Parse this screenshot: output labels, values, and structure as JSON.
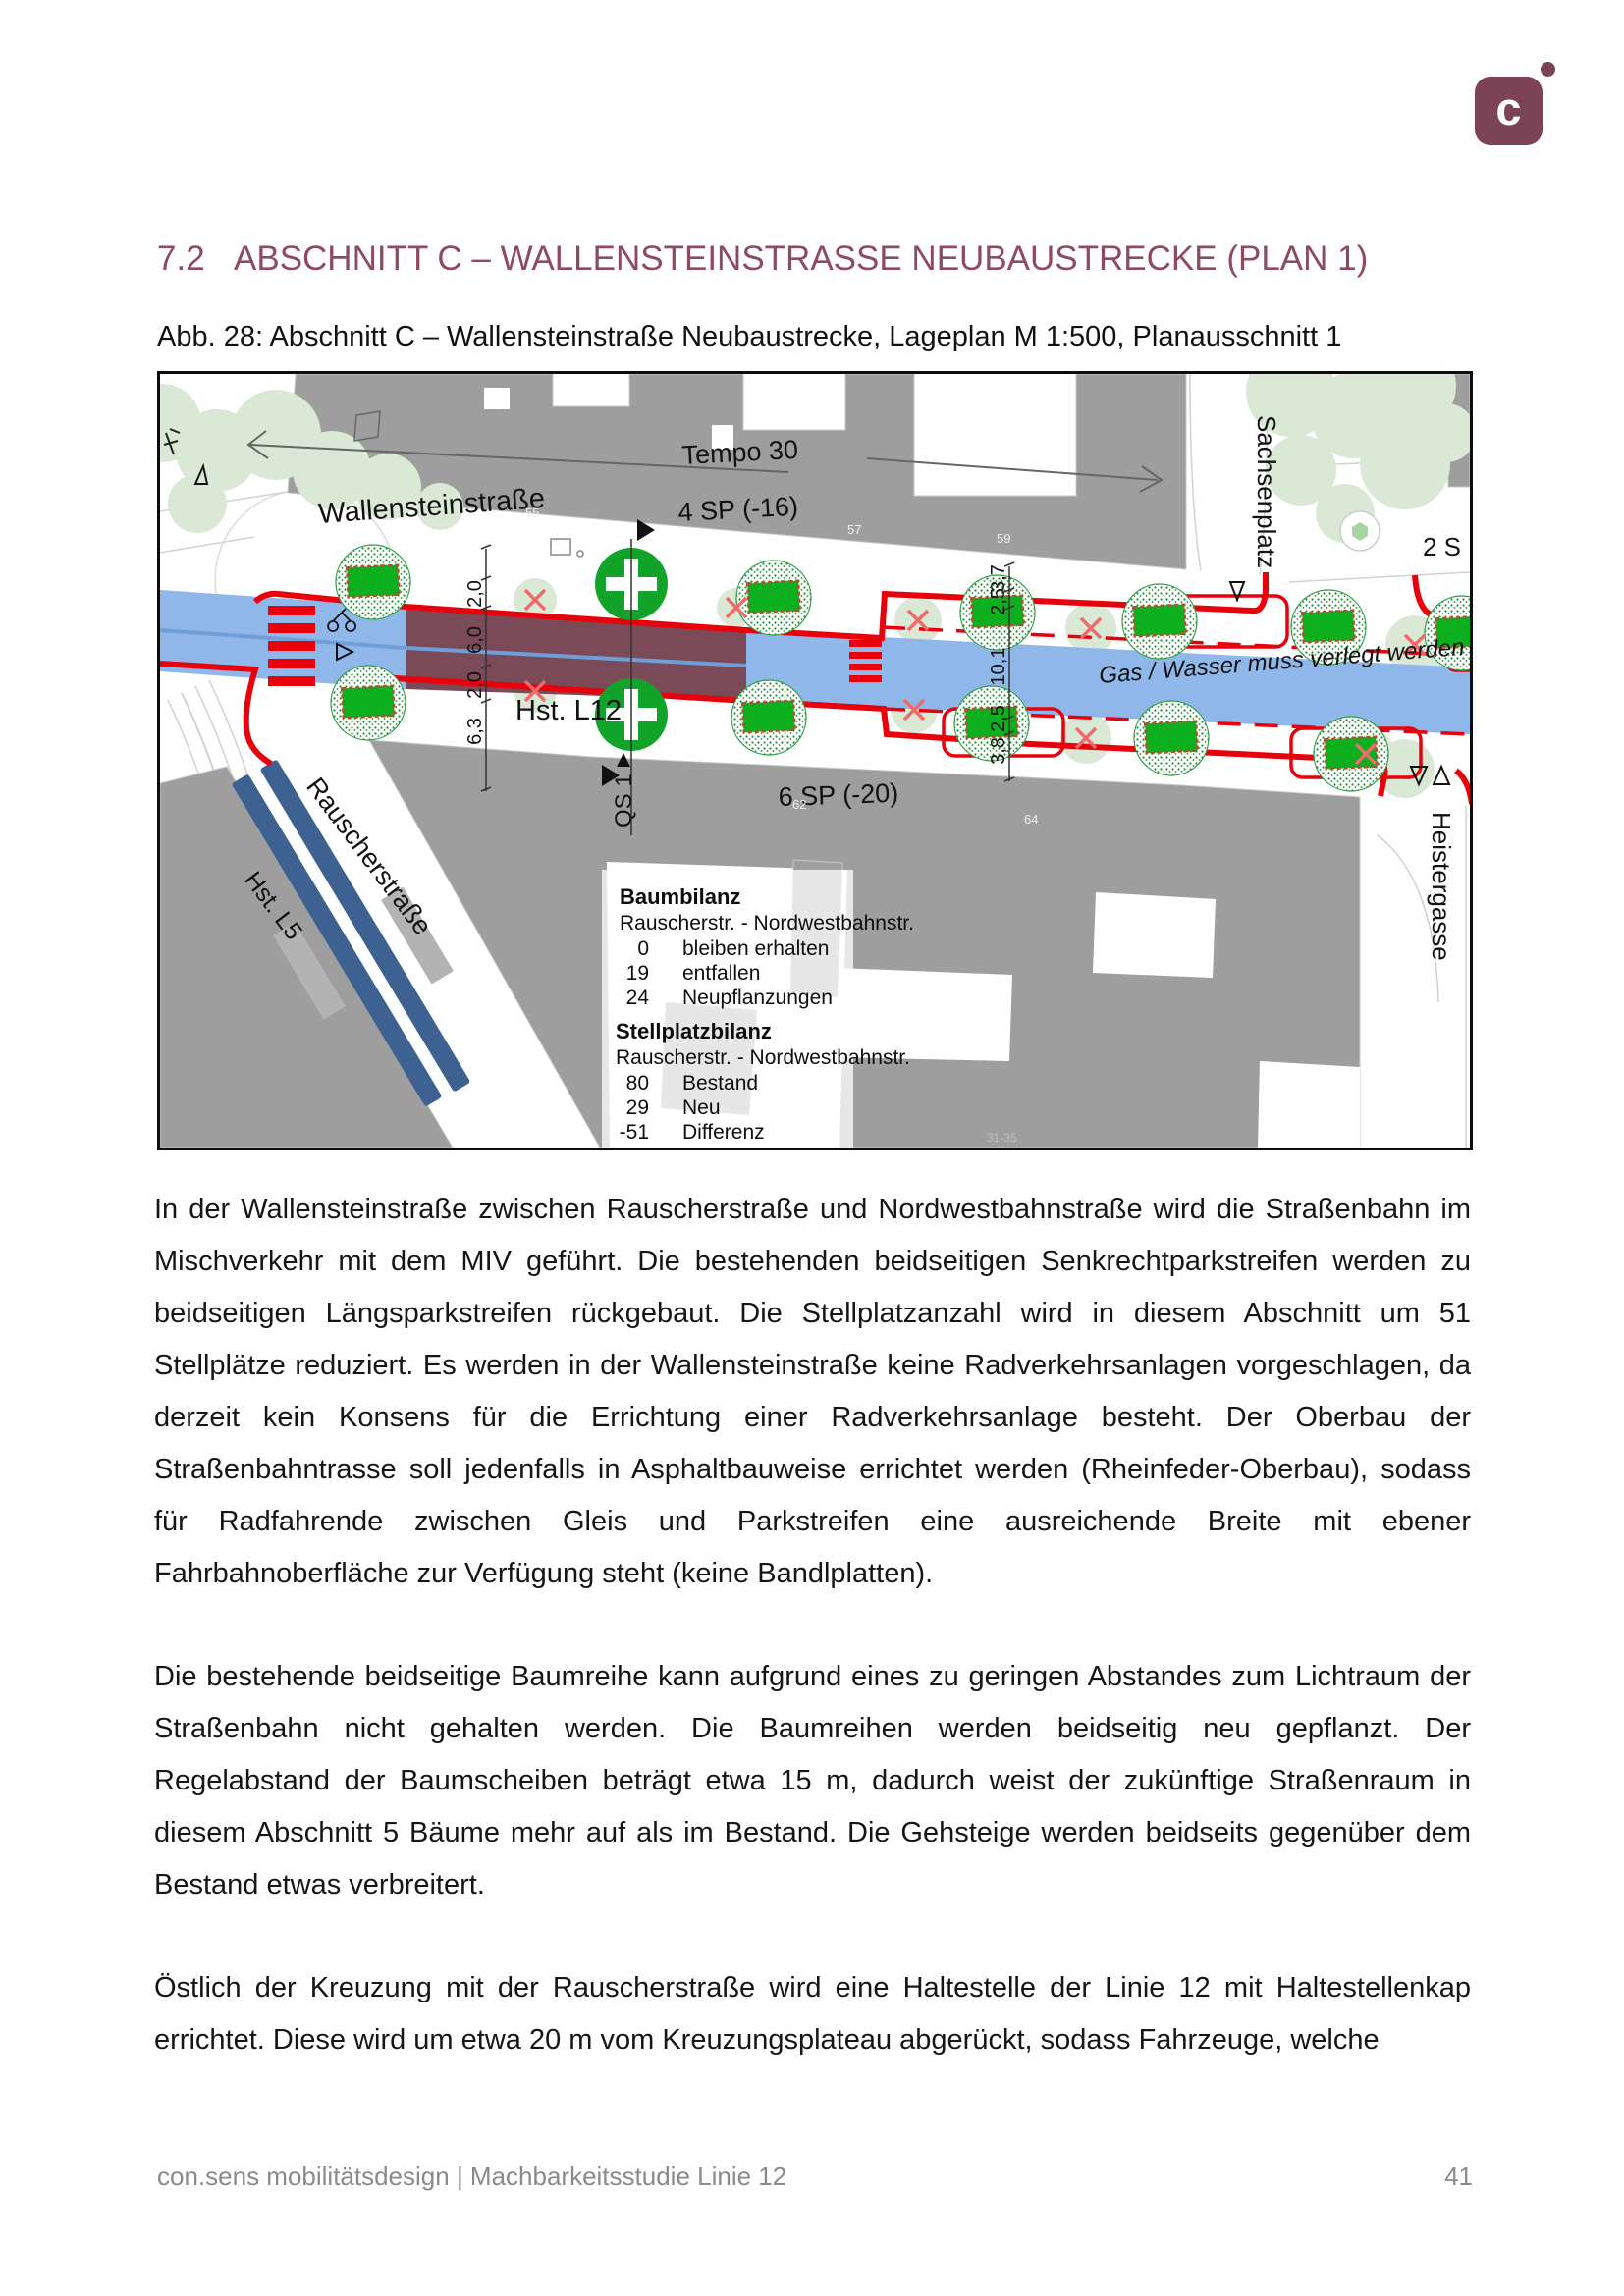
{
  "page": {
    "logo": {
      "letter": "c",
      "color": "#7b4355"
    },
    "heading": {
      "number": "7.2",
      "title": "ABSCHNITT C – WALLENSTEINSTRASSE NEUBAUSTRECKE (PLAN 1)",
      "color": "#8e4b60"
    },
    "caption": "Abb. 28: Abschnitt C – Wallensteinstraße Neubaustrecke, Lageplan M 1:500, Planausschnitt 1",
    "paragraphs": [
      "In der Wallensteinstraße zwischen Rauscherstraße und Nordwestbahnstraße wird die Straßenbahn im Mischverkehr mit dem MIV geführt. Die bestehenden beidseitigen Senkrechtparkstreifen werden zu beidseitigen Längsparkstreifen rückgebaut. Die Stellplatzanzahl wird in diesem Abschnitt um 51 Stellplätze reduziert. Es werden in der Wallensteinstraße keine Radverkehrsanlagen vorgeschlagen, da derzeit kein Konsens für die Errichtung einer Radverkehrsanlage besteht. Der Oberbau der Straßenbahntrasse soll jedenfalls in Asphaltbauweise errichtet werden (Rheinfeder-Oberbau), sodass für Radfahrende zwischen Gleis und Parkstreifen eine ausreichende Breite mit ebener Fahrbahnoberfläche zur Verfügung steht (keine Bandlplatten).",
      "Die bestehende beidseitige Baumreihe kann aufgrund eines zu geringen Abstandes zum Lichtraum der Straßenbahn nicht gehalten werden. Die Baumreihen werden beidseitig neu gepflanzt. Der Regelabstand der Baumscheiben beträgt etwa 15 m, dadurch weist der zukünftige Straßenraum in diesem Abschnitt 5 Bäume mehr auf als im Bestand. Die Gehsteige werden beidseits gegenüber dem Bestand etwas verbreitert.",
      "Östlich der Kreuzung mit der Rauscherstraße wird eine Haltestelle der Linie 12 mit Haltestellenkap errichtet. Diese wird um etwa 20 m vom Kreuzungsplateau abgerückt, sodass Fahrzeuge, welche"
    ],
    "footer": {
      "left": "con.sens mobilitätsdesign | Machbarkeitsstudie Linie 12",
      "page_number": "41"
    },
    "map": {
      "street_labels": {
        "wallensteinstrasse": "Wallensteinstraße",
        "rauscherstrasse": "Rauscherstraße",
        "sachsenplatz": "Sachsenplatz",
        "heistergasse": "Heistergasse"
      },
      "annotations": {
        "tempo": "Tempo 30",
        "sp_north": "4 SP (-16)",
        "sp_south": "6 SP (-20)",
        "hst_l12": "Hst. L12",
        "hst_l5": "Hst. L5",
        "qs1": "QS 1",
        "gas_note": "Gas / Wasser muss verlegt werden",
        "clipped_east": "2 S"
      },
      "dims_west": [
        "6,0",
        "2,0",
        "6,0",
        "2,0",
        "6,3"
      ],
      "dims_east": [
        "3,7",
        "2,5",
        "10,1",
        "2,5",
        "3,8"
      ],
      "house_numbers": [
        "55",
        "57",
        "59",
        "62",
        "64",
        "31-35"
      ],
      "baumbilanz": {
        "title": "Baumbilanz",
        "subtitle": "Rauscherstr. - Nordwestbahnstr.",
        "rows": [
          {
            "n": "0",
            "t": "bleiben erhalten"
          },
          {
            "n": "19",
            "t": "entfallen"
          },
          {
            "n": "24",
            "t": "Neupflanzungen"
          }
        ]
      },
      "stellplatzbilanz": {
        "title": "Stellplatzbilanz",
        "subtitle": "Rauscherstr. - Nordwestbahnstr.",
        "rows": [
          {
            "n": "80",
            "t": "Bestand"
          },
          {
            "n": "29",
            "t": "Neu"
          },
          {
            "n": "-51",
            "t": "Differenz"
          }
        ]
      },
      "colors": {
        "roadway_blue": "#8fb7ea",
        "tram_mixed_maroon": "#7a4a58",
        "platform_blue": "#3d6291",
        "new_curb_red": "#e8000b",
        "tree_new_green": "#0cb01e",
        "building_gray": "#9e9e9e",
        "existing_tree_green": "#d9e9d6"
      }
    }
  }
}
